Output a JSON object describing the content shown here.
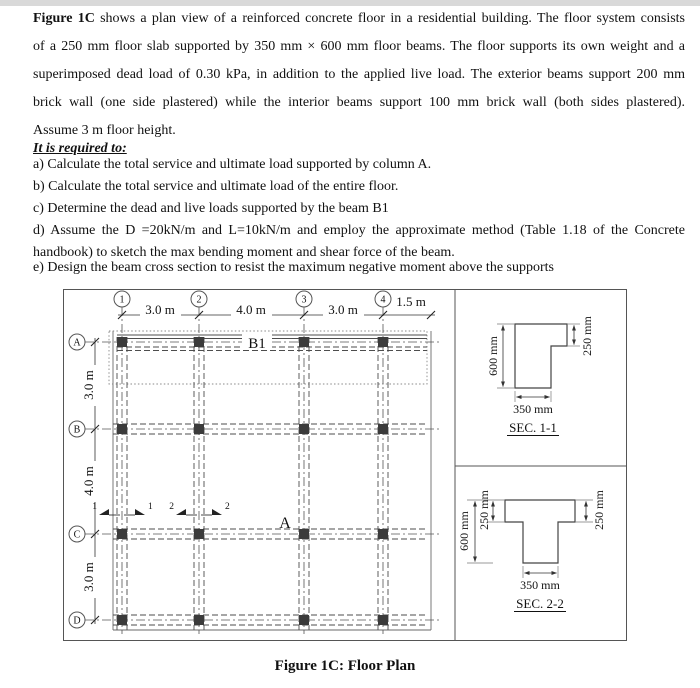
{
  "intro": {
    "lead_bold": "Figure 1C",
    "line1_rest": " shows a plan view of a reinforced concrete floor in a residential building. The floor system consists",
    "line2": "of a 250 mm floor slab supported by 350 mm × 600 mm floor beams. The floor supports its own weight and a",
    "line3": "superimposed dead load of 0.30 kPa, in addition to the applied live load. The exterior beams support 200 mm",
    "line4": "brick wall (one side plastered) while the interior beams support 100 mm brick wall (both sides plastered).",
    "line5": "Assume 3 m floor height.",
    "required_heading": "It is required to:"
  },
  "requirements": {
    "a": "a) Calculate the total service and ultimate load supported by column A.",
    "b": "b) Calculate the total service and ultimate load of the entire floor.",
    "c": "c) Determine the dead and live loads supported by the beam B1",
    "d1": "d) Assume the D =20kN/m and L=10kN/m and employ the approximate method (Table 1.18 of the Concrete",
    "d2": "handbook) to sketch the max bending moment and shear force of the beam.",
    "e": "e) Design the beam cross section to resist the maximum negative moment above the supports"
  },
  "plan": {
    "grid_cols": [
      "1",
      "2",
      "3",
      "4"
    ],
    "grid_rows": [
      "A",
      "B",
      "C",
      "D"
    ],
    "dims_top": [
      "3.0 m",
      "4.0 m",
      "3.0 m",
      "1.5 m"
    ],
    "dims_left": [
      "3.0 m",
      "4.0 m",
      "3.0 m"
    ],
    "beam_label": "B1",
    "column_label": "A",
    "section_marks": [
      "1",
      "1",
      "2",
      "2"
    ]
  },
  "sections": {
    "sec1": {
      "title": "SEC. 1-1",
      "depth": "600 mm",
      "flange": "250 mm",
      "width": "350 mm"
    },
    "sec2": {
      "title": "SEC. 2-2",
      "depth": "600 mm",
      "flange_left": "250 mm",
      "flange_right": "250 mm",
      "width": "350 mm"
    }
  },
  "caption": "Figure 1C: Floor Plan",
  "colors": {
    "line": "#4d4d4d",
    "column_fill": "#3b3b3b",
    "band": "#d9d9d9"
  }
}
